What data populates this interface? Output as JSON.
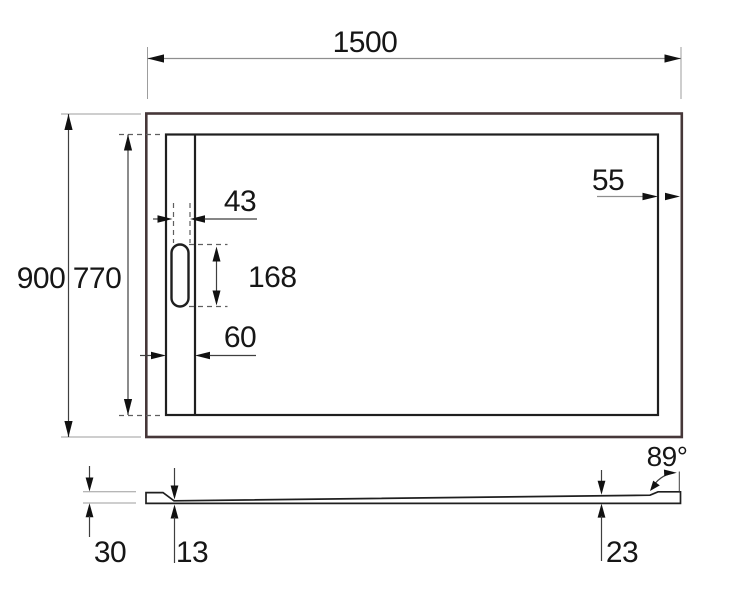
{
  "drawing": {
    "background": "#ffffff",
    "colors": {
      "outline": "#1f1f1f",
      "outer_frame": "#463739",
      "dimension_line": "#3f3f3f",
      "light_dimension_line": "#8e8e8e",
      "extension_line": "#9d9d9d",
      "text": "#161616"
    },
    "top_view": {
      "width": "1500",
      "outer_depth": "900",
      "inner_depth": "770",
      "slot_width": "43",
      "slot_length": "168",
      "channel_width": "60",
      "edge_clearance": "55"
    },
    "side_view": {
      "edge_height": "30",
      "thickness_at_drain": "13",
      "thickness_at_end": "23",
      "edge_angle": "89°"
    }
  }
}
